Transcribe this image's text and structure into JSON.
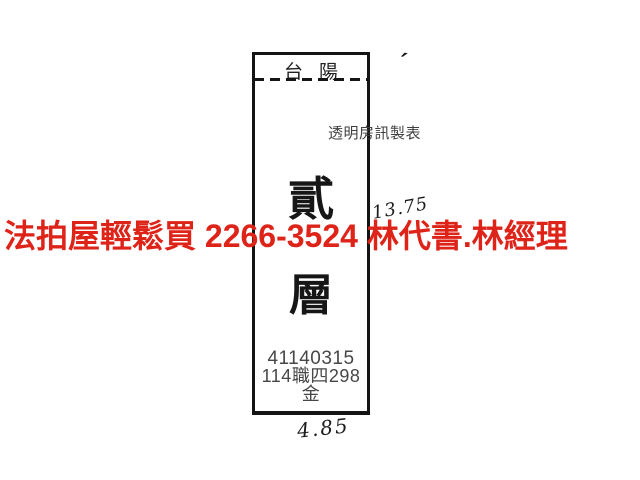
{
  "colors": {
    "background": "#ffffff",
    "line": "#141414",
    "ink": "#222222",
    "print_gray": "#474747",
    "watermark_red": "#de2318"
  },
  "diagram": {
    "building_label": {
      "left_char": "台",
      "right_char": "陽"
    },
    "maker_label": "透明房訊製表",
    "floor_label": {
      "top_char": "貳",
      "bottom_char": "層"
    },
    "case_number": "41140315",
    "case_reference": "114職四298金",
    "dimensions": {
      "right_side": "13.75",
      "bottom_side": "4.85"
    },
    "corner_tick": "′"
  },
  "watermark": {
    "text": "法拍屋輕鬆買  2266-3524  林代書.林經理"
  }
}
